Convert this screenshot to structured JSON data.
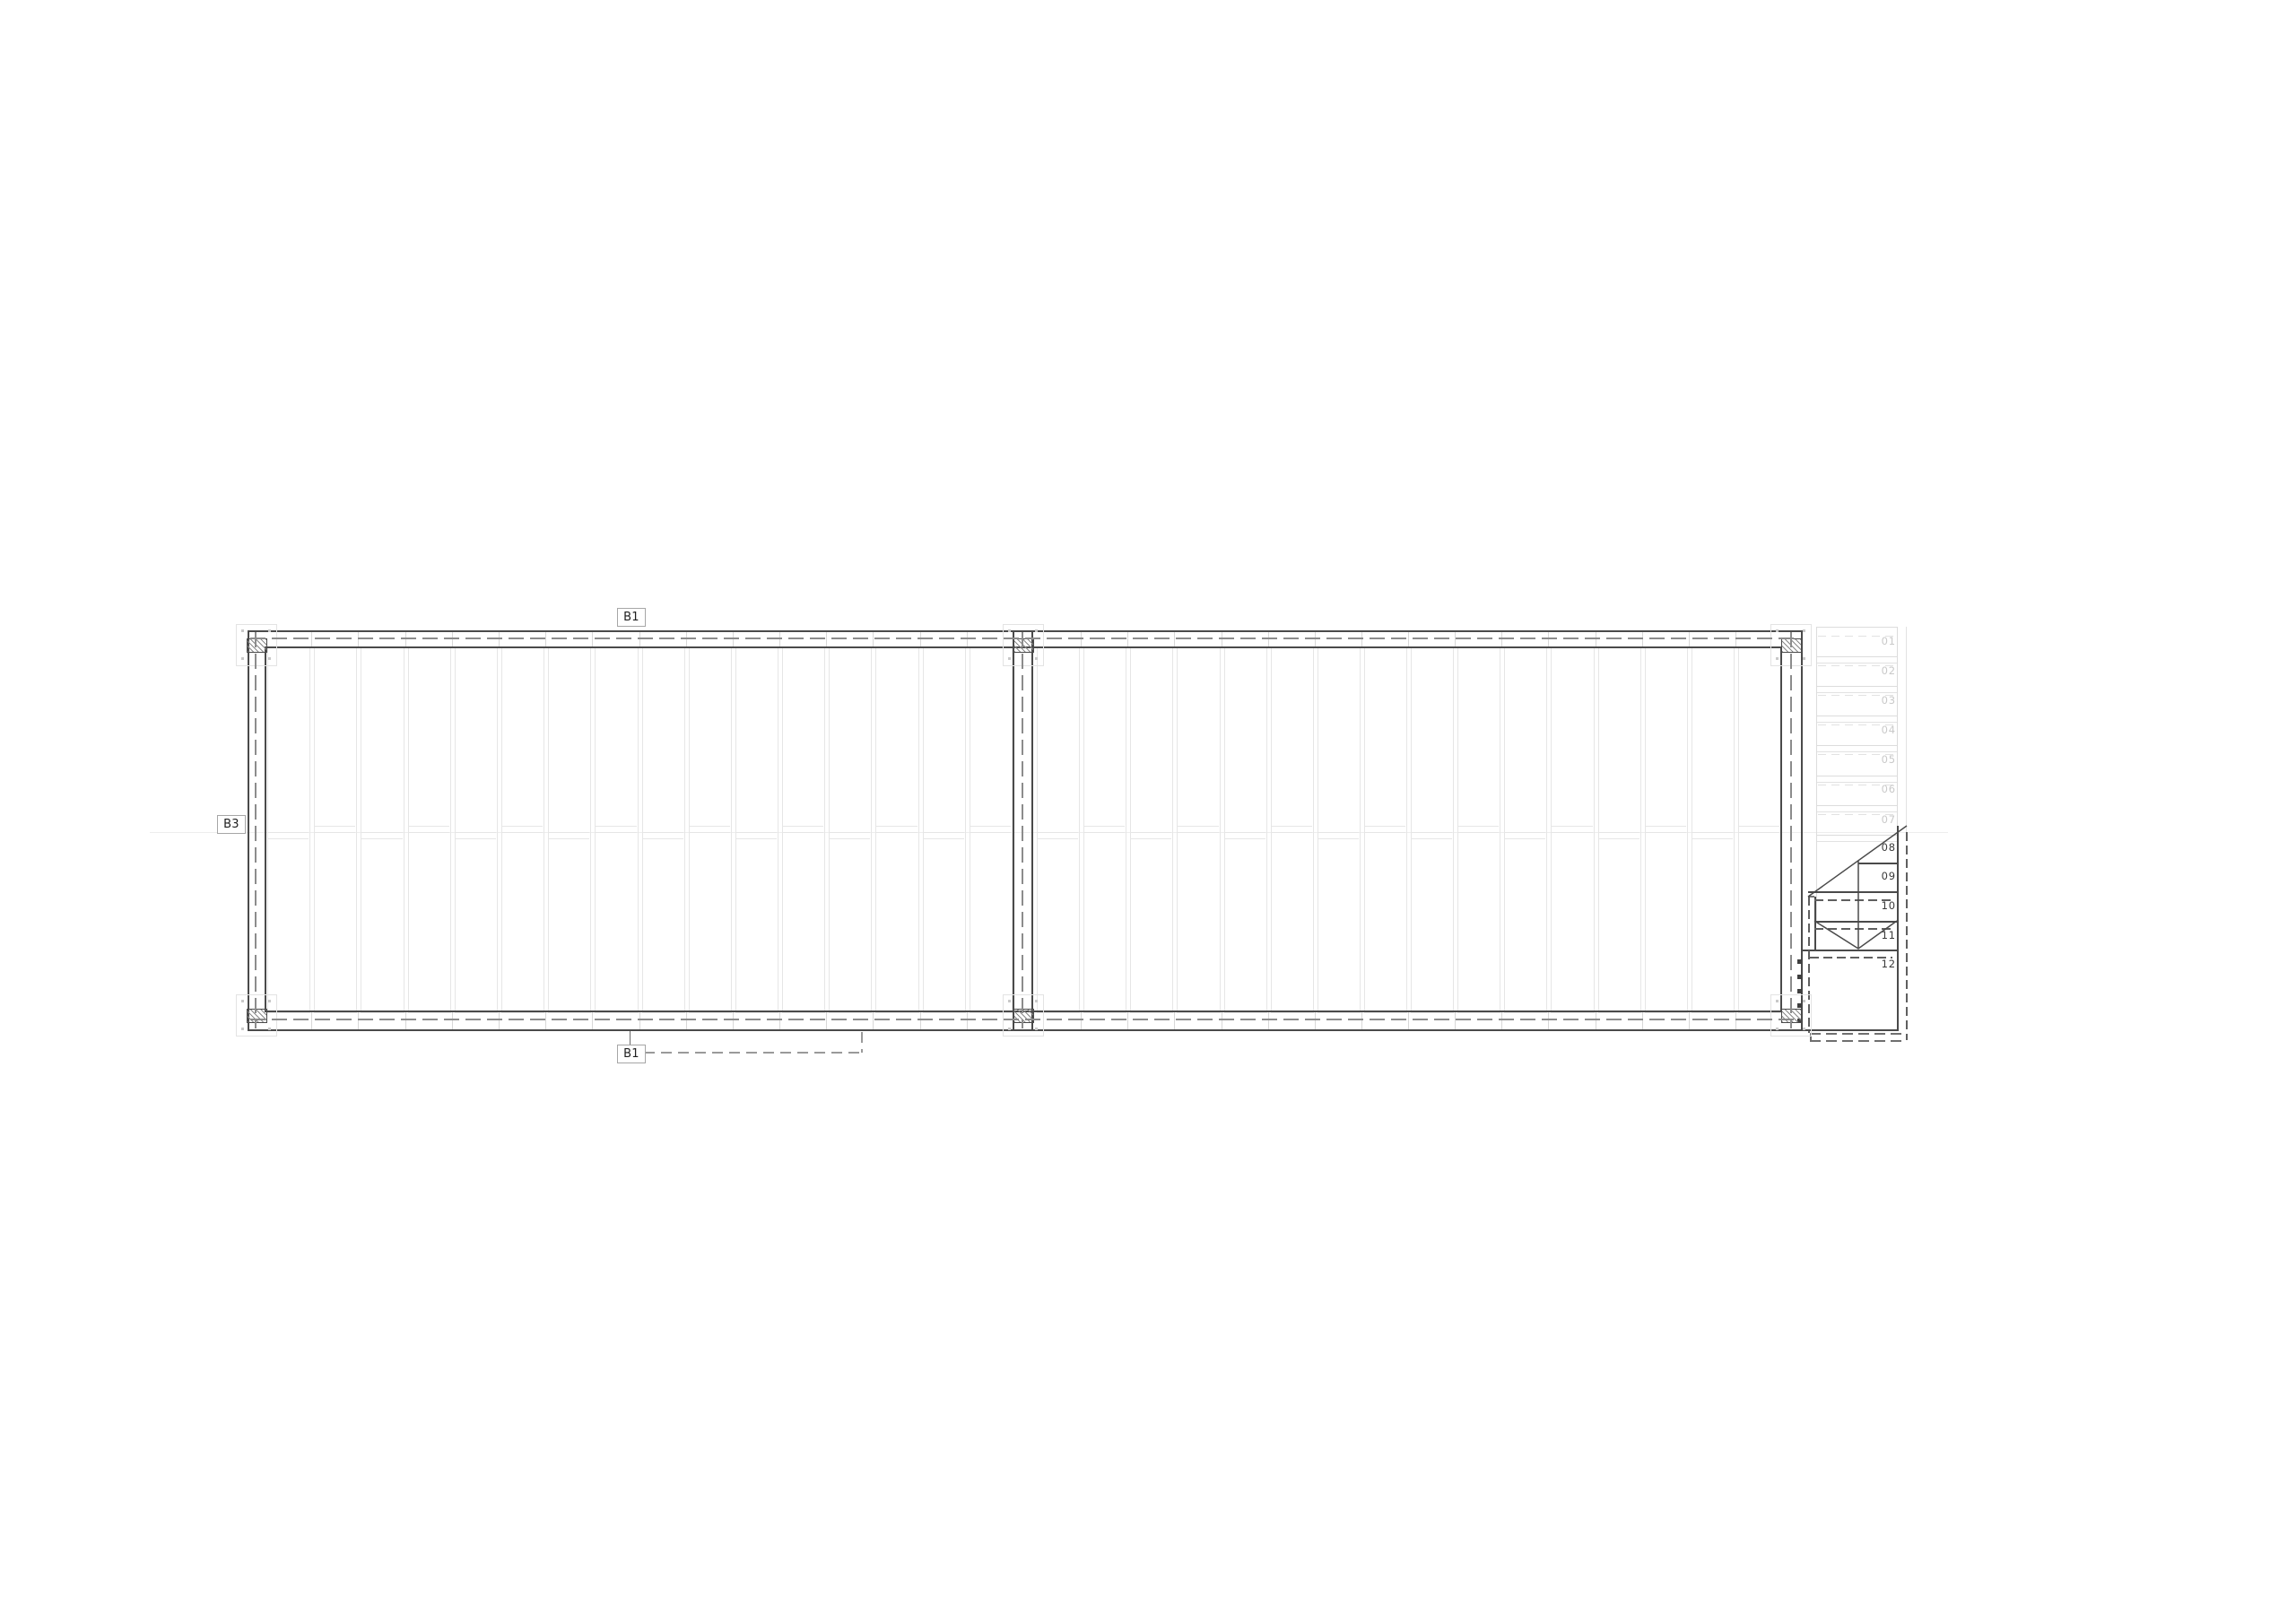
{
  "labels": {
    "top_beam": "B1",
    "left_beam": "B3",
    "bottom_beam": "B1"
  },
  "stair": {
    "treads": [
      {
        "label": "01",
        "state": "hidden"
      },
      {
        "label": "02",
        "state": "hidden"
      },
      {
        "label": "03",
        "state": "hidden"
      },
      {
        "label": "04",
        "state": "hidden"
      },
      {
        "label": "05",
        "state": "hidden"
      },
      {
        "label": "06",
        "state": "hidden"
      },
      {
        "label": "07",
        "state": "hidden"
      },
      {
        "label": "08",
        "state": "visible"
      },
      {
        "label": "09",
        "state": "visible"
      },
      {
        "label": "10",
        "state": "visible"
      },
      {
        "label": "11",
        "state": "visible"
      },
      {
        "label": "12",
        "state": "visible"
      }
    ]
  },
  "colors": {
    "background": "#ffffff",
    "wall_line": "#4a4a4a",
    "wall_dash": "#8c8c8c",
    "panel_line": "#e6e6e6",
    "tread_line": "#dcdcdc",
    "tread_text_hidden": "#c9c9c9",
    "tread_text_visible": "#3a3a3a",
    "tag_border": "#a6a6a6",
    "tag_text": "#1f1f1f"
  }
}
